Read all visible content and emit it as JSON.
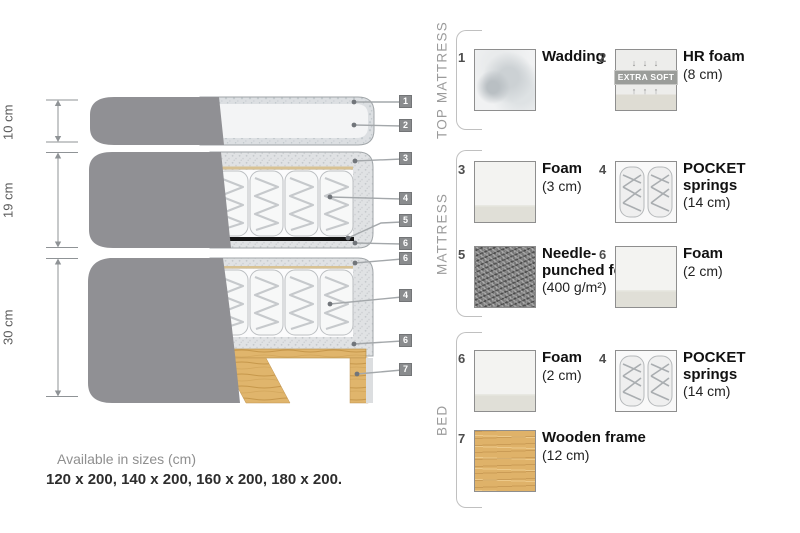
{
  "colors": {
    "cover_gray": "#909094",
    "foam_speckle": "#e0e2e4",
    "wadding_speckle": "#dcdfe2",
    "tan_layer": "#d8c294",
    "felt_black": "#141414",
    "wood": "#dfb269",
    "tag_gray": "#8a8c8e",
    "text_gray": "#9b9b9b"
  },
  "diagram": {
    "sections": [
      {
        "name": "top-mattress",
        "dimension": "10 cm"
      },
      {
        "name": "mattress",
        "dimension": "19 cm"
      },
      {
        "name": "bed",
        "dimension": "30 cm"
      }
    ],
    "tags": [
      "1",
      "2",
      "3",
      "4",
      "5",
      "6",
      "6",
      "4",
      "6",
      "7"
    ]
  },
  "legend": {
    "groups": [
      {
        "label": "TOP MATTRESS",
        "items": [
          {
            "num": "1",
            "name": "Wadding",
            "size": ""
          },
          {
            "num": "2",
            "name": "HR foam",
            "size": "(8 cm)",
            "badge": "EXTRA SOFT",
            "arrows_down": "↓ ↓ ↓",
            "arrows_up": "↑ ↑ ↑"
          }
        ]
      },
      {
        "label": "MATTRESS",
        "items": [
          {
            "num": "3",
            "name": "Foam",
            "size": "(3 cm)"
          },
          {
            "num": "4",
            "name": "POCKET springs",
            "size": "(14 cm)"
          },
          {
            "num": "5",
            "name": "Needle-punched felt",
            "size": "(400 g/m²)"
          },
          {
            "num": "6",
            "name": "Foam",
            "size": "(2 cm)"
          }
        ]
      },
      {
        "label": "BED",
        "items": [
          {
            "num": "6",
            "name": "Foam",
            "size": "(2 cm)"
          },
          {
            "num": "4",
            "name": "POCKET springs",
            "size": "(14 cm)"
          },
          {
            "num": "7",
            "name": "Wooden frame",
            "size": "(12 cm)"
          }
        ]
      }
    ]
  },
  "footer": {
    "line1": "Available in sizes (cm)",
    "line2": "120 x 200, 140 x 200, 160 x 200, 180 x 200."
  }
}
